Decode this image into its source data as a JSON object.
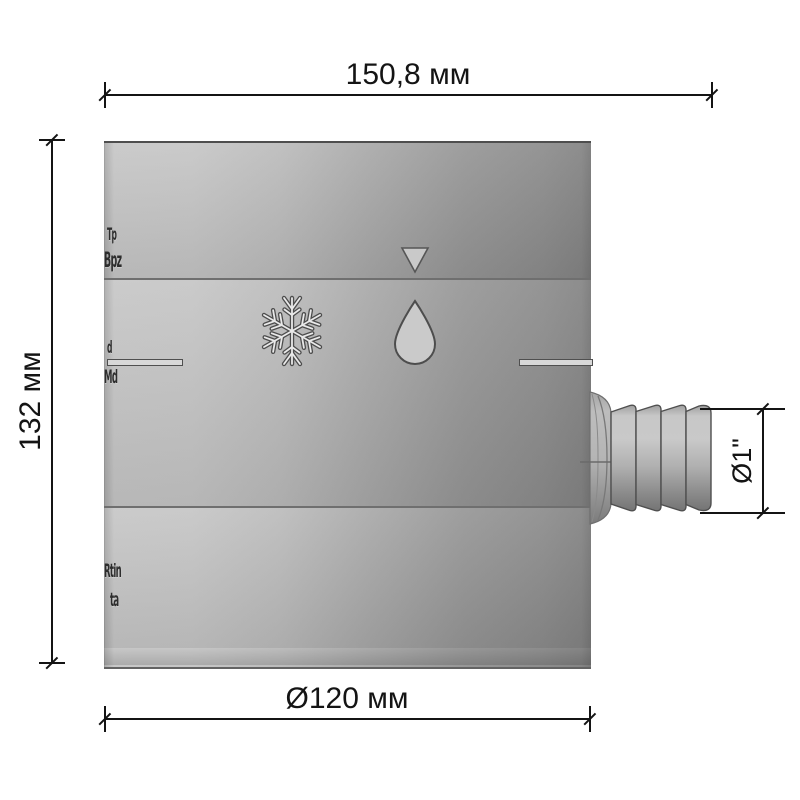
{
  "drawing": {
    "type": "technical-dimension-drawing",
    "subject": "cylindrical rain water collector with hose barb spout",
    "dimensions": {
      "width": {
        "label": "150,8 мм"
      },
      "height": {
        "label": "132 мм"
      },
      "diameter": {
        "label": "Ø120 мм"
      },
      "spout": {
        "label": "Ø1\""
      }
    },
    "embossed_marks": [
      "Tp",
      "Bpz",
      "d",
      "Md",
      "Rtin",
      "ta"
    ],
    "icons": [
      "triangle-down",
      "snowflake",
      "water-drop"
    ],
    "colors": {
      "background": "#ffffff",
      "body_light": "#c6c6c6",
      "body_dark": "#858585",
      "outline": "#4f4f4f",
      "dimension": "#141414"
    }
  }
}
